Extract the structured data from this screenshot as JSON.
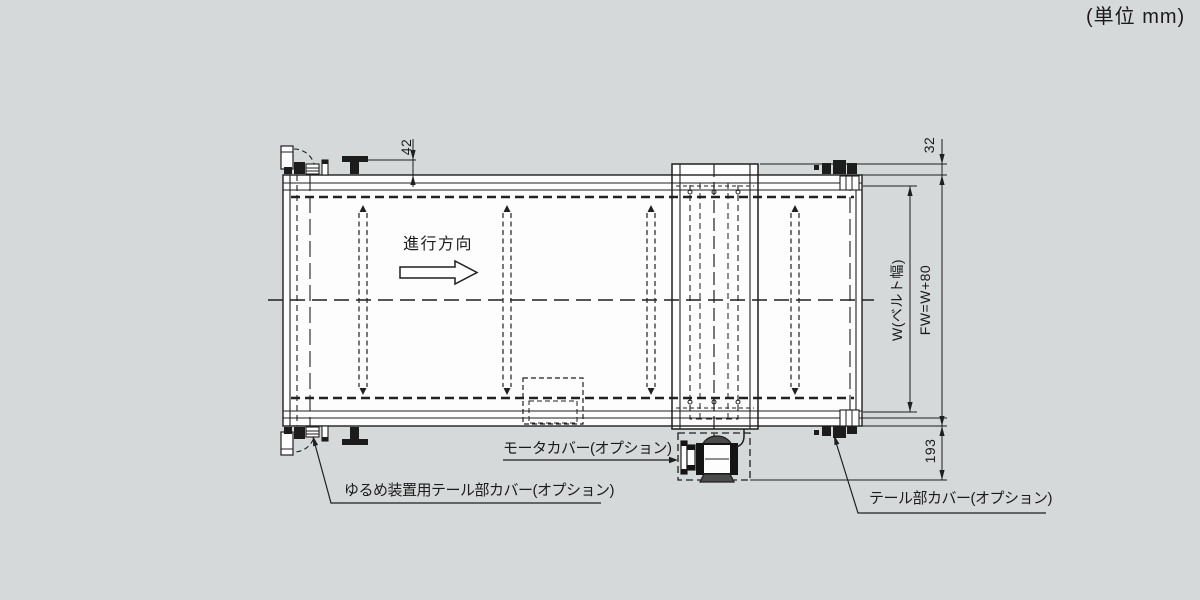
{
  "page": {
    "unit_note": "(単位 mm)",
    "colors": {
      "background": "#d6d9da",
      "paper": "#fdfdfd",
      "line": "#1f1f1f"
    }
  },
  "drawing": {
    "direction_label": "進行方向",
    "dimensions": {
      "tail_bracket_height": "42",
      "drive_plate_height": "32",
      "belt_width": "W(ベルト幅)",
      "frame_width": "FW=W+80",
      "motor_drop": "193"
    },
    "callouts": {
      "motor_cover": "モータカバー(オプション)",
      "loosening_tail_cover": "ゆるめ装置用テール部カバー(オプション)",
      "tail_cover": "テール部カバー(オプション)"
    }
  }
}
